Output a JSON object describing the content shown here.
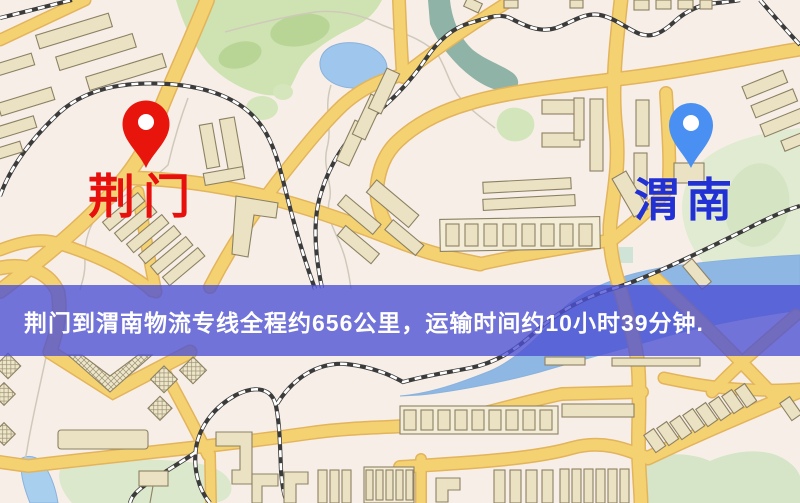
{
  "map": {
    "origin": {
      "name": "荆门",
      "pin_color": "#e8150d",
      "label_color": "#e8100c"
    },
    "destination": {
      "name": "渭南",
      "pin_color": "#4a90f2",
      "label_color": "#2231d4"
    },
    "banner": {
      "text": "荆门到渭南物流专线全程约656公里，运输时间约10小时39分钟.",
      "distance": "656公里",
      "duration": "10小时39分钟",
      "bg_color": "#4c50d4",
      "text_color": "#ffffff"
    },
    "legend_colors": {
      "road": "#f4d272",
      "railway": "#3b3b3b",
      "water": "#9fc6ec",
      "park": "#cfe3b2",
      "building": "#ebe2c4"
    }
  }
}
